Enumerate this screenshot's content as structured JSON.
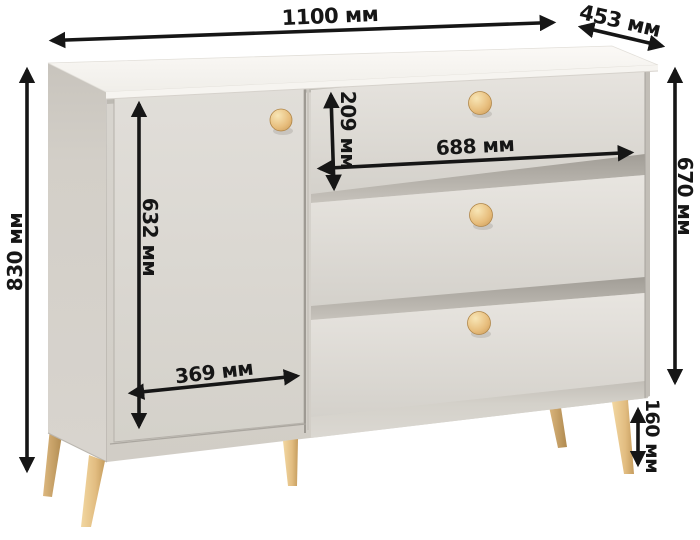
{
  "figure": {
    "subject": "chest-of-drawers-with-door-and-three-drawers",
    "units": "мм"
  },
  "dimensions": {
    "top_width": "1100 мм",
    "top_depth": "453 мм",
    "overall_height": "830 мм",
    "right_height": "670 мм",
    "top_drawer_height": "209 мм",
    "drawer_width": "688 мм",
    "door_height": "632 мм",
    "door_width": "369 мм",
    "leg_height": "160 мм"
  },
  "colors": {
    "background": "#ffffff",
    "arrow": "#161616",
    "label_text": "#161616",
    "cabinet_top": "#f7f5f1",
    "cabinet_side": "#d2cec7",
    "cabinet_front": "#dcd9d3",
    "drawer_front": "#e0ddd8",
    "gap_shadow": "#aba79f",
    "wood_knob": "#e6c183",
    "wood_leg": "#e3c28a"
  }
}
